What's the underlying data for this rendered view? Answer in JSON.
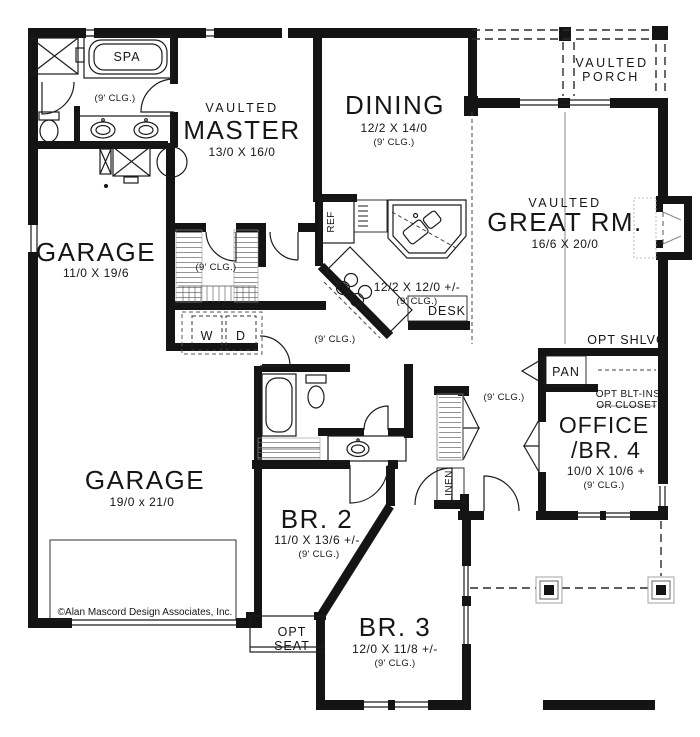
{
  "plan": {
    "rooms": {
      "master": {
        "tag": "VAULTED",
        "name": "MASTER",
        "dims": "13/0 X 16/0"
      },
      "dining": {
        "name": "DINING",
        "dims": "12/2 X 14/0",
        "clg": "(9' CLG.)"
      },
      "great_room": {
        "tag": "VAULTED",
        "name": "GREAT RM.",
        "dims": "16/6 X 20/0"
      },
      "vaulted_porch": {
        "name1": "VAULTED",
        "name2": "PORCH"
      },
      "garage_upper": {
        "name": "GARAGE",
        "dims": "11/0 X 19/6"
      },
      "garage_lower": {
        "name": "GARAGE",
        "dims": "19/0 x 21/0"
      },
      "kitchen": {
        "dims": "12/2 X 12/0 +/-",
        "clg": "(9' CLG.)"
      },
      "office_br4": {
        "name1": "OFFICE",
        "name2": "/BR. 4",
        "dims": "10/0 X 10/6 +",
        "clg": "(9' CLG.)"
      },
      "bedroom2": {
        "name": "BR. 2",
        "dims": "11/0 X 13/6 +/-",
        "clg": "(9' CLG.)"
      },
      "bedroom3": {
        "name": "BR. 3",
        "dims": "12/0 X 11/8 +/-",
        "clg": "(9' CLG.)"
      },
      "master_bath": {
        "clg": "(9' CLG.)"
      },
      "walkin_closet": {
        "clg": "(9' CLG.)"
      },
      "hall": {
        "clg": "(9' CLG.)"
      },
      "entry": {
        "clg": "(9' CLG.)"
      }
    },
    "fixtures": {
      "spa": "SPA",
      "fridge": "REF",
      "desk": "DESK",
      "pantry": "PAN",
      "linen": "LINEN",
      "washer": "W",
      "dryer": "D",
      "opt_seat_line1": "OPT",
      "opt_seat_line2": "SEAT",
      "opt_shelving": "OPT SHLVG",
      "opt_builtins_line1": "OPT BLT-INS",
      "opt_builtins_line2": "OR CLOSET"
    },
    "copyright": "©Alan Mascord Design Associates, Inc."
  }
}
